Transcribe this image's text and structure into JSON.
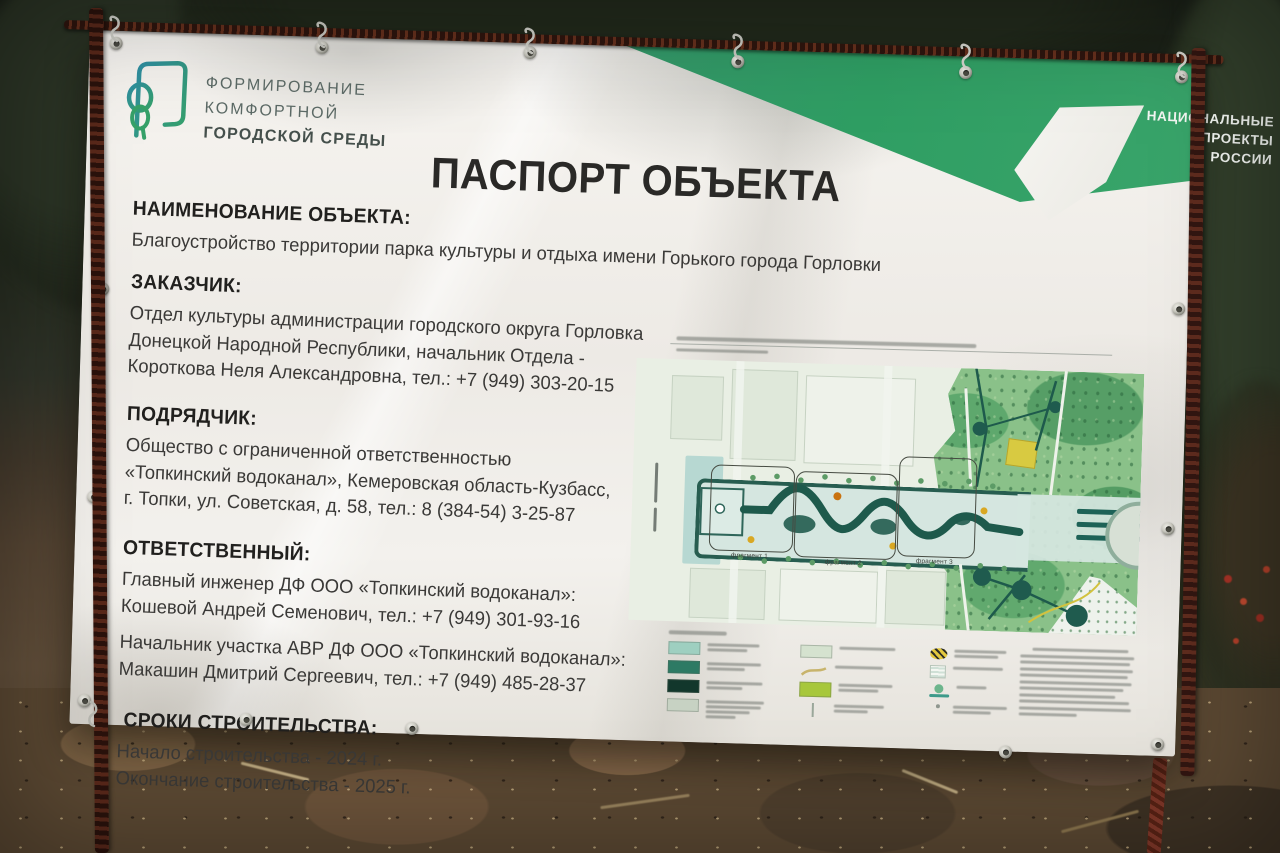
{
  "photo": {
    "banner": {
      "program_logo": {
        "line1": "ФОРМИРОВАНИЕ",
        "line2": "КОМФОРТНОЙ",
        "line3": "ГОРОДСКОЙ СРЕДЫ"
      },
      "national_projects": {
        "line1": "НАЦИОНАЛЬНЫЕ",
        "line2": "ПРОЕКТЫ",
        "line3": "РОССИИ"
      },
      "title": "ПАСПОРТ ОБЪЕКТА",
      "sections": [
        {
          "heading": "НАИМЕНОВАНИЕ ОБЪЕКТА:",
          "lines": [
            "Благоустройство территории парка культуры и отдыха имени Горького города Горловки"
          ]
        },
        {
          "heading": "ЗАКАЗЧИК:",
          "lines": [
            "Отдел культуры администрации городского округа Горловка",
            "Донецкой Народной Республики, начальник Отдела -",
            "Короткова Неля Александровна, тел.: +7 (949) 303-20-15"
          ]
        },
        {
          "heading": "ПОДРЯДЧИК:",
          "lines": [
            "Общество с ограниченной ответственностью",
            "«Топкинский водоканал», Кемеровская область-Кузбасс,",
            "г. Топки, ул. Советская, д. 58, тел.: 8 (384-54) 3-25-87"
          ]
        },
        {
          "heading": "ОТВЕТСТВЕННЫЙ:",
          "lines": [
            "Главный инженер ДФ ООО «Топкинский водоканал»:",
            "Кошевой Андрей Семенович, тел.: +7 (949) 301-93-16",
            "Начальник участка АВР ДФ ООО «Топкинский водоканал»:",
            "Макашин Дмитрий Сергеевич, тел.: +7 (949) 485-28-37"
          ]
        },
        {
          "heading": "СРОКИ СТРОИТЕЛЬСТВА:",
          "lines": [
            "Начало строительства - 2024 г.",
            "Окончание строительства - 2025 г."
          ]
        }
      ],
      "site_plan": {
        "fragments": [
          "фрагмент 1",
          "фрагмент 2",
          "фрагмент 3"
        ]
      },
      "colors": {
        "national_projects_green": "#2f9e63",
        "program_teal": "#2f8fa3",
        "program_green": "#36a169",
        "plan_path_dark": "#1e5a4c"
      }
    }
  }
}
